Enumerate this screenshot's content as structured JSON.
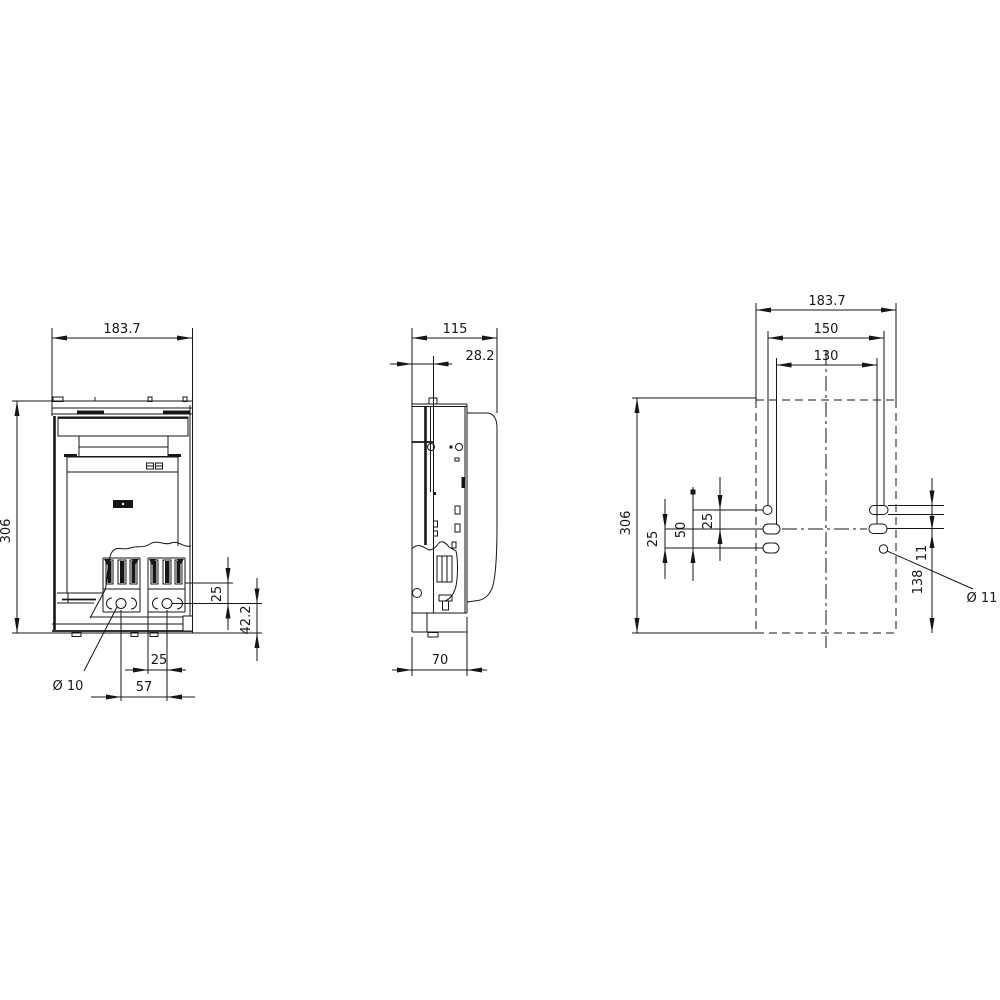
{
  "drawing": {
    "front": {
      "width": "183.7",
      "height": "306",
      "slot_offset": "25",
      "base_height": "42.2",
      "hole_offset": "25",
      "hole_pitch": "57",
      "hole_dia": "Ø 10"
    },
    "side": {
      "depth": "115",
      "front_offset": "28.2",
      "base_depth": "70"
    },
    "plan": {
      "width": "183.7",
      "pitch_outer": "150",
      "pitch_inner": "130",
      "height": "306",
      "offset_lower": "25",
      "offset_mid": "50",
      "offset_upper": "25",
      "slot_width": "11",
      "bottom_offset": "138",
      "hole_dia": "Ø 11"
    }
  }
}
